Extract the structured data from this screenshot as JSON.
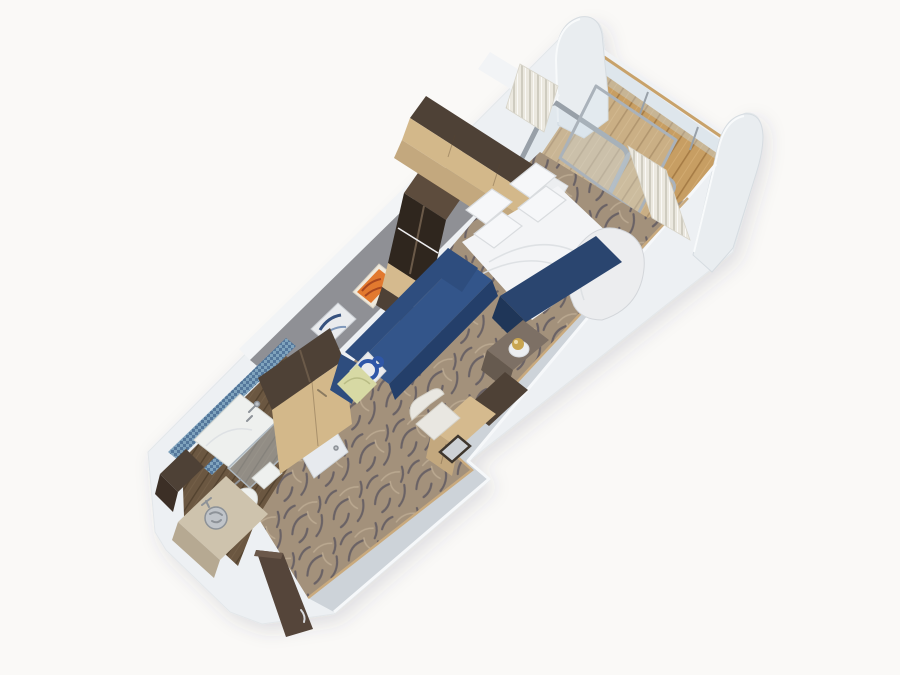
{
  "image": {
    "kind": "3d-cutaway-floorplan-render",
    "subject": "cruise-ship balcony stateroom seen from above at an angle",
    "rooms": [
      "balcony",
      "sleeping-area",
      "sitting-area",
      "desk-area",
      "bathroom",
      "entry-corridor"
    ],
    "objects": [
      "balcony-deck",
      "glass-balustrade",
      "divider-panels",
      "sliding-glass-door",
      "curtains",
      "double-bed",
      "pillows",
      "navy-bed-runner",
      "foot-bench",
      "overhead-cabinet",
      "wardrobe",
      "navy-sofa",
      "throw-pillows",
      "wall-art-orange",
      "wall-art-blue",
      "closet",
      "side-table",
      "ice-bucket",
      "desk",
      "chair",
      "shower",
      "toilet",
      "sink-counter",
      "entry-door",
      "swirl-carpet"
    ]
  },
  "palette": {
    "bg": "#faf9f7",
    "wall_face": "#edf0f3",
    "wall_inner": "#cdd3d9",
    "white_strip": "#f2f4f6",
    "gray_wall": "#8f9095",
    "carpet_base": "#a3917b",
    "carpet_swirl_dark": "#514e5c",
    "carpet_swirl_light": "#c4b399",
    "deck_wood": "#c79e63",
    "deck_seam": "#a67c46",
    "rail_cap": "#c8a26a",
    "frame_gray": "#98a0a8",
    "curtain": "#ebe8df",
    "curtain_shadow": "#cfccc0",
    "navy": "#2e4d7e",
    "navy_seat": "#33558a",
    "navy_front": "#243f6a",
    "runner": "#2a456f",
    "runner_dark": "#1f3658",
    "bed_white": "#f3f4f6",
    "pillow_white": "#f6f7f9",
    "pillow_shadow": "#d9dcdf",
    "bench_white": "#ecedef",
    "wood_dark": "#4e4136",
    "wood_open": "#2f261e",
    "wood_mid": "#5d4c3d",
    "wood_light": "#d5ba8e",
    "wood_light2": "#c3a87e",
    "tan_front": "#d3b88a",
    "table_wood": "#7d7065",
    "bath_floor": "#6b5741",
    "bath_seam": "#53422f",
    "counter": "#cec3ad",
    "counter_front": "#b6a992",
    "chrome": "#c0c4c9",
    "chrome_line": "#8d9298",
    "mosaic_a": "#7fa3bd",
    "mosaic_b": "#54779b",
    "white_fix": "#eef0ee",
    "door_brown": "#55453a",
    "door_brown_dark": "#3c2f26",
    "gold": "#c9a550",
    "art_orange": "#e2792f",
    "art_orange_dark": "#a8471f",
    "art_blue": "#36517e",
    "pillow_green": "#d7d9a4",
    "pillow_green_fold": "#b9bc85",
    "pillow_pat_blue": "#2f57a8",
    "baseboard": "#c9aa7e"
  }
}
